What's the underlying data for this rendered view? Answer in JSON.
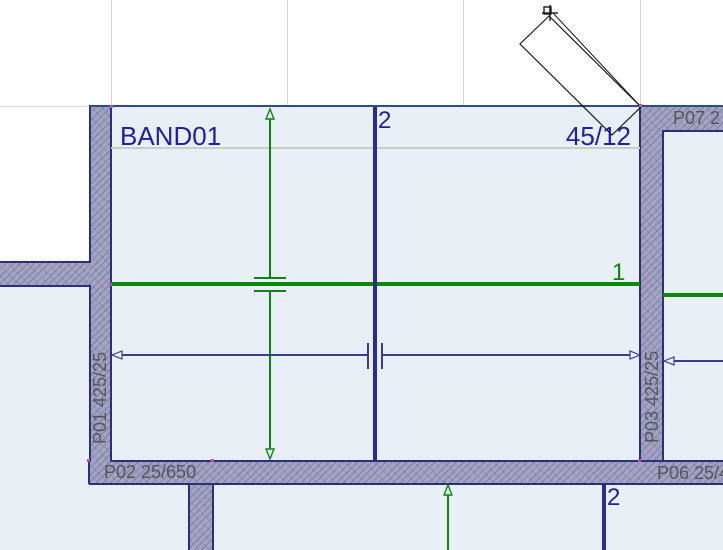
{
  "canvas": {
    "band": {
      "name": "BAND01",
      "section": "45/12"
    },
    "beams": {
      "beam1_label": "1",
      "beam2_label": "2",
      "beam2_lower_label": "2"
    },
    "walls": [
      {
        "id": "P01",
        "label": "P01 425/25"
      },
      {
        "id": "P02",
        "label": "P02 25/650"
      },
      {
        "id": "P03",
        "label": "P03 425/25"
      },
      {
        "id": "P06",
        "label": "P06 25/4"
      },
      {
        "id": "P07",
        "label": "P07 2"
      }
    ],
    "colors": {
      "background": "#ffffff",
      "room_fill": "#e9eff7",
      "wall_fill": "#a3a3c3",
      "wall_border": "#2c2f7d",
      "band_top_edge": "#2f4d7d",
      "band_separator": "#cdcdc7",
      "gridline": "#d5d5da",
      "beam_green": "#0c870c",
      "beam_blue": "#2b2b94",
      "dimension_blue": "#3c3c8c",
      "label_navy": "#1e1ea8",
      "label_gray": "#55555f",
      "snap_dot": "#c050c0",
      "preview_outline": "#1a1a1a"
    }
  }
}
